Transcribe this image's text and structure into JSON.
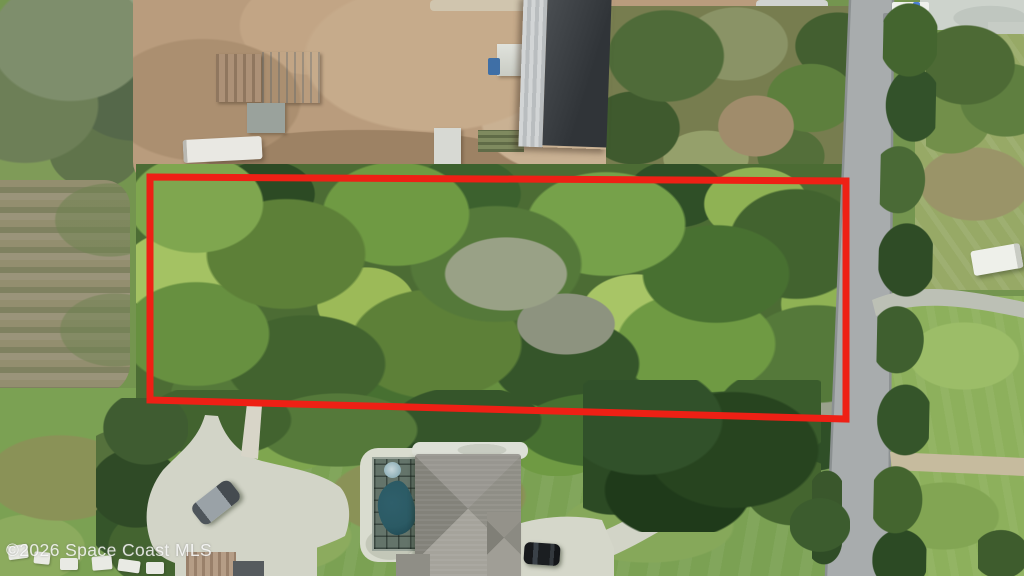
{
  "image": {
    "kind": "aerial real-estate photograph",
    "subject": "wooded vacant lot outlined in red beside a road, farm yard above, house with pool below",
    "watermark": "©2026 Space Coast MLS"
  },
  "colors": {
    "boundary-red": "#ee2015",
    "road-gray": "#a8acad",
    "dirt-tan": "#b99c7d",
    "forest-green": "#4c6c34",
    "lawn-green": "#7ba153",
    "concrete": "#d2d4c7",
    "gravel-path": "#d8d5c8",
    "dirt-road": "#c6bb9e",
    "pool-teal": "#2b5a64",
    "watermark-white": "rgba(255,255,255,0.82)"
  }
}
